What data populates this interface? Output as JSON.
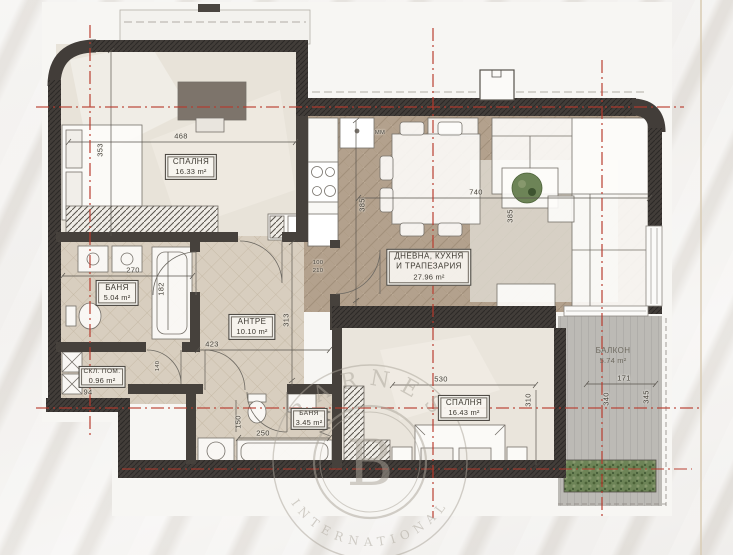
{
  "plan_title": "apartment-floor-plan",
  "watermark": {
    "brand": "BARNES",
    "sub": "INTERNATIONAL",
    "monogram": "B"
  },
  "rooms": {
    "bedroom1": {
      "name": "СПАЛНЯ",
      "area": "16.33 m²"
    },
    "bath1": {
      "name": "БАНЯ",
      "area": "5.04 m²"
    },
    "storage": {
      "name": "СКЛ. ПОМ.",
      "area": "0.96 m²"
    },
    "hall": {
      "name": "АНТРЕ",
      "area": "10.10 m²"
    },
    "living": {
      "name_line1": "ДНЕВНА, КУХНЯ",
      "name_line2": "И ТРАПЕЗАРИЯ",
      "area": "27.96 m²"
    },
    "bedroom2": {
      "name": "СПАЛНЯ",
      "area": "16.43 m²"
    },
    "bath2": {
      "name": "БАНЯ",
      "area": "3.45 m²"
    },
    "balcony": {
      "name": "БАЛКОН",
      "area": "5.74 m²"
    }
  },
  "dimensions": {
    "d468": "468",
    "d353": "353",
    "d270": "270",
    "d182": "182",
    "d423": "423",
    "d313": "313",
    "d385a": "385",
    "d740": "740",
    "d385b": "385",
    "d530": "530",
    "d310": "310",
    "d171": "171",
    "d340": "340",
    "d345": "345",
    "d150": "150",
    "d250": "250",
    "d94": "94",
    "d140": "140",
    "door_w": "100",
    "door_h": "210",
    "mm": "ММ"
  },
  "colors": {
    "axis_red": "#b83a2c",
    "wall_dark": "#423d39",
    "wood_floor": "#b5a38f",
    "tile_floor": "#d9cfc0",
    "deck_gray": "#bdbbb6",
    "plant_green": "#5d7a49",
    "watermark_gray": "#aaa499"
  }
}
